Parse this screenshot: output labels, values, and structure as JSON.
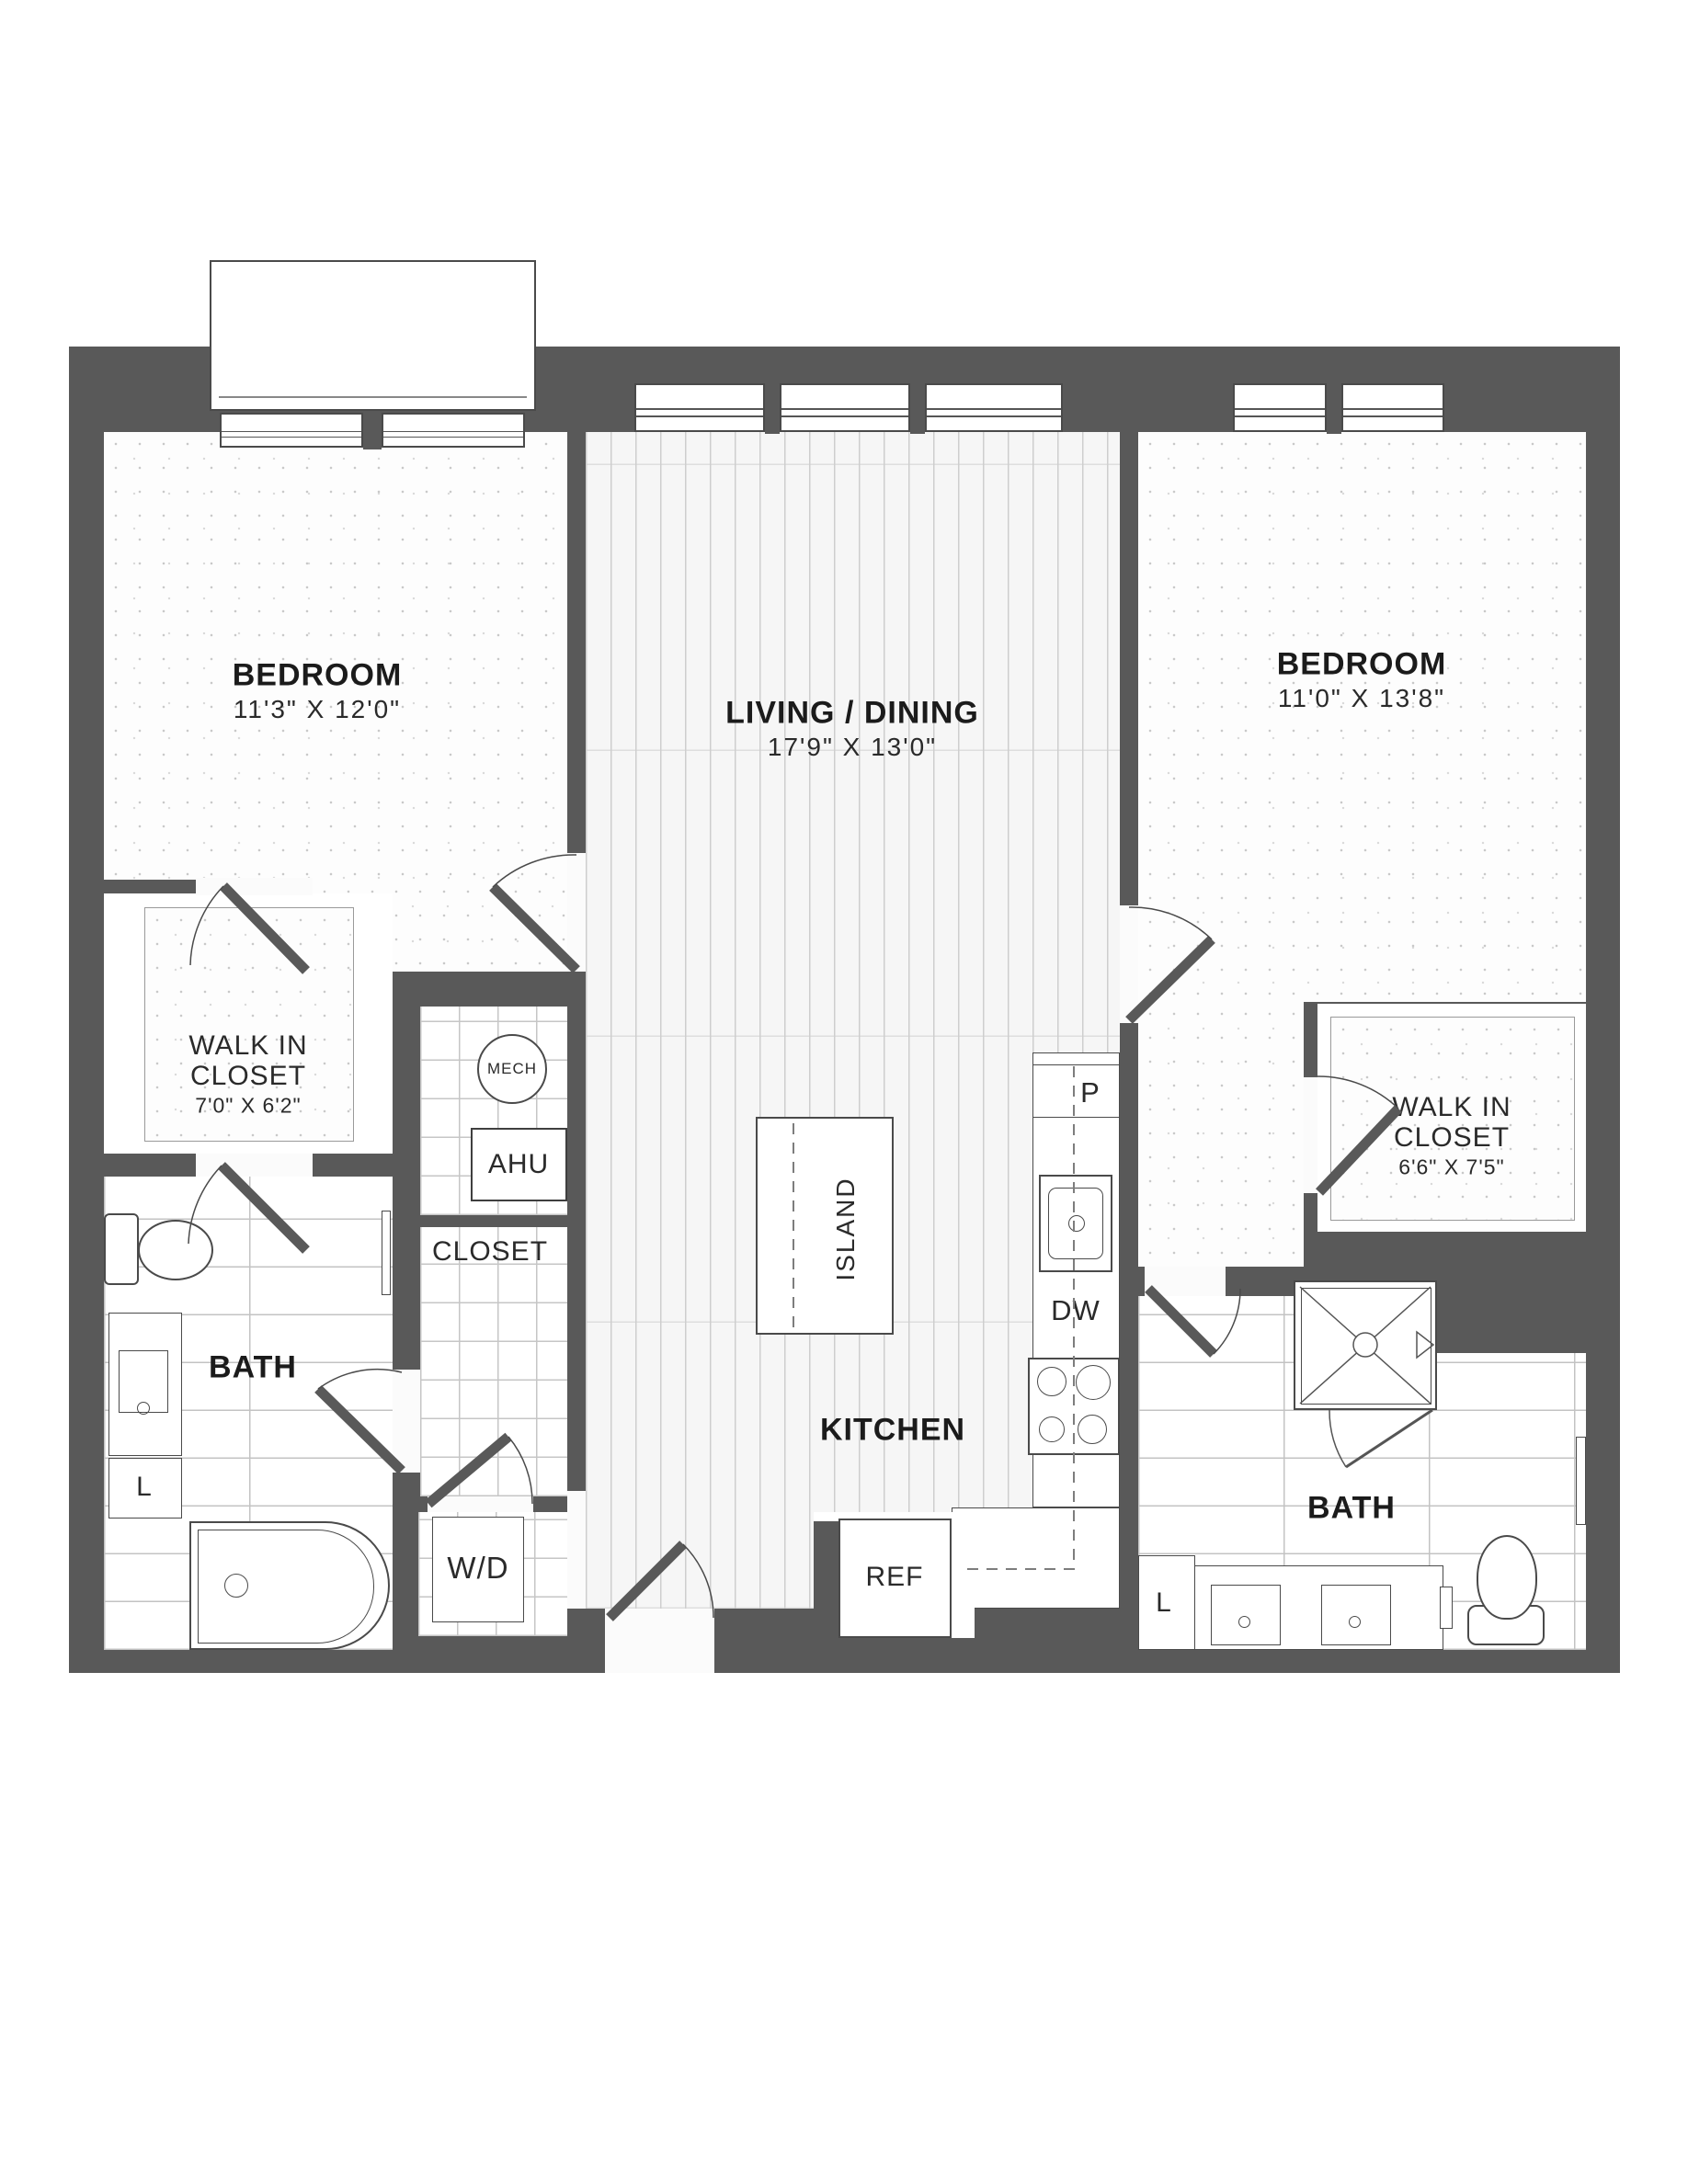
{
  "plan": {
    "rooms": {
      "bedroom_left": {
        "name": "BEDROOM",
        "dims": "11'3\" X 12'0\""
      },
      "living_dining": {
        "name": "LIVING / DINING",
        "dims": "17'9\" X 13'0\""
      },
      "bedroom_right": {
        "name": "BEDROOM",
        "dims": "11'0\" X 13'8\""
      },
      "walk_in_closet_left": {
        "name1": "WALK IN",
        "name2": "CLOSET",
        "dims": "7'0\" X 6'2\""
      },
      "walk_in_closet_right": {
        "name1": "WALK IN",
        "name2": "CLOSET",
        "dims": "6'6\" X 7'5\""
      },
      "bath_left": {
        "name": "BATH"
      },
      "bath_right": {
        "name": "BATH"
      },
      "kitchen": {
        "name": "KITCHEN"
      },
      "closet": {
        "name": "CLOSET"
      }
    },
    "fixtures": {
      "mech": "MECH",
      "ahu": "AHU",
      "washer_dryer": "W/D",
      "island": "ISLAND",
      "refrigerator": "REF",
      "dishwasher": "DW",
      "pantry": "P",
      "linen_left": "L",
      "linen_right": "L"
    },
    "colors": {
      "wall": "#595959",
      "line": "#3f3f3f",
      "text": "#1b1b1b"
    }
  }
}
